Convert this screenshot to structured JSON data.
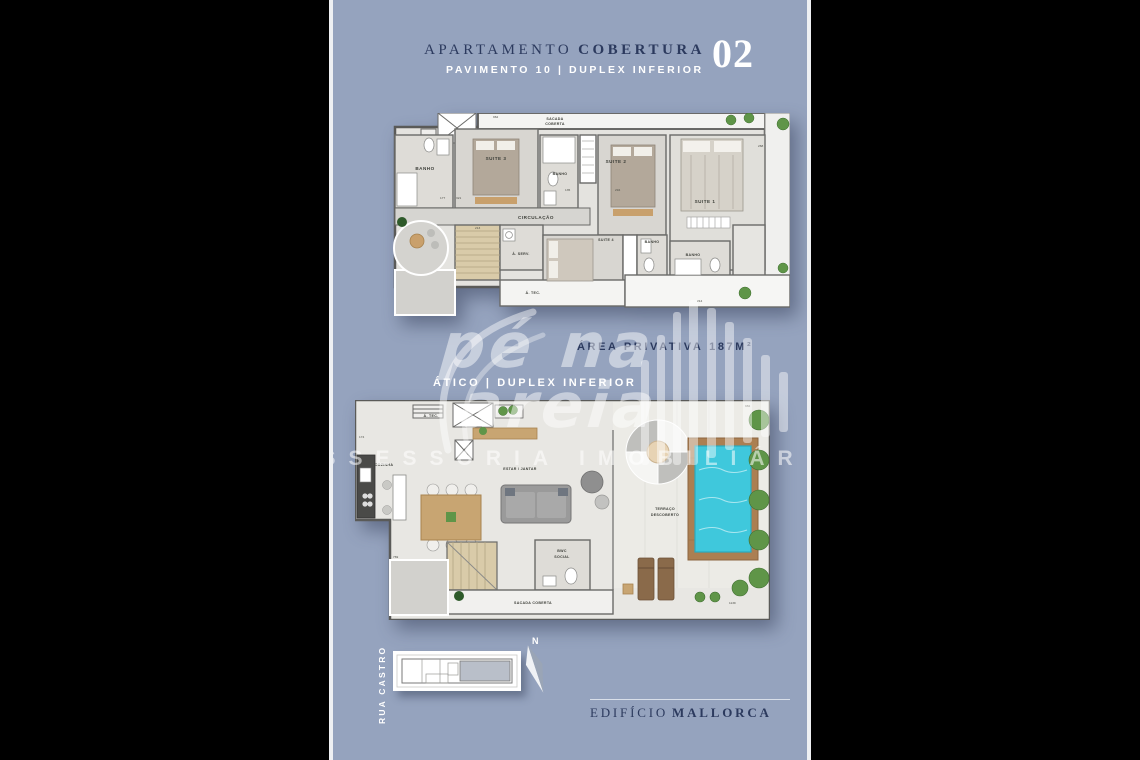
{
  "header": {
    "title_light": "APARTAMENTO",
    "title_bold": "COBERTURA",
    "unit": "02",
    "subtitle": "PAVIMENTO 10 | DUPLEX INFERIOR"
  },
  "area": {
    "label": "ÁREA PRIVATIVA",
    "value": "187M²"
  },
  "atico": {
    "heading": "ÁTICO | DUPLEX INFERIOR"
  },
  "upper_plan": {
    "labels": {
      "sacada1": "SACADA",
      "sacada2": "COBERTA",
      "banho1": "BANHO",
      "suite3": "SUITE 3",
      "banho2": "BANHO",
      "suite2": "SUITE 2",
      "suite1": "SUITE 1",
      "circulacao": "CIRCULAÇÃO",
      "aserv": "Á. SERV.",
      "suite4": "SUITE 4",
      "banho3": "BANHO",
      "banho4": "BANHO",
      "atec": "Á. TEC."
    },
    "dims": [
      "177",
      "321",
      "135",
      "294",
      "962",
      "268",
      "213",
      "214"
    ]
  },
  "lower_plan": {
    "labels": {
      "atec": "Á. TEC.",
      "cozinha": "COZINHA",
      "estar": "ESTAR / JANTAR",
      "terraco1": "TERRAÇO",
      "terraco2": "DESCOBERTO",
      "bwc1": "BWC",
      "bwc2": "SOCIAL",
      "sacada": "SACADA COBERTA"
    },
    "dims": [
      "174",
      "769",
      "982",
      "1139"
    ]
  },
  "watermark": {
    "brand_line1": "pé na",
    "brand_line2": "areia",
    "tagline": "ASSESSORIA IMOBILIÁRIA"
  },
  "site": {
    "street": "RUA CASTRO",
    "compass_label": "N"
  },
  "footer": {
    "edificio": "EDIFÍCIO",
    "name": "MALLORCA"
  },
  "colors": {
    "background": "#000000",
    "panel": "#95A3BE",
    "navy": "#2C3A5E",
    "white": "#FFFFFF",
    "wall": "#5A5A58",
    "floor": "#E4E3DF",
    "pool_water": "#3FC8DC",
    "plant_green": "#5F9548",
    "wood": "#C8A572"
  }
}
